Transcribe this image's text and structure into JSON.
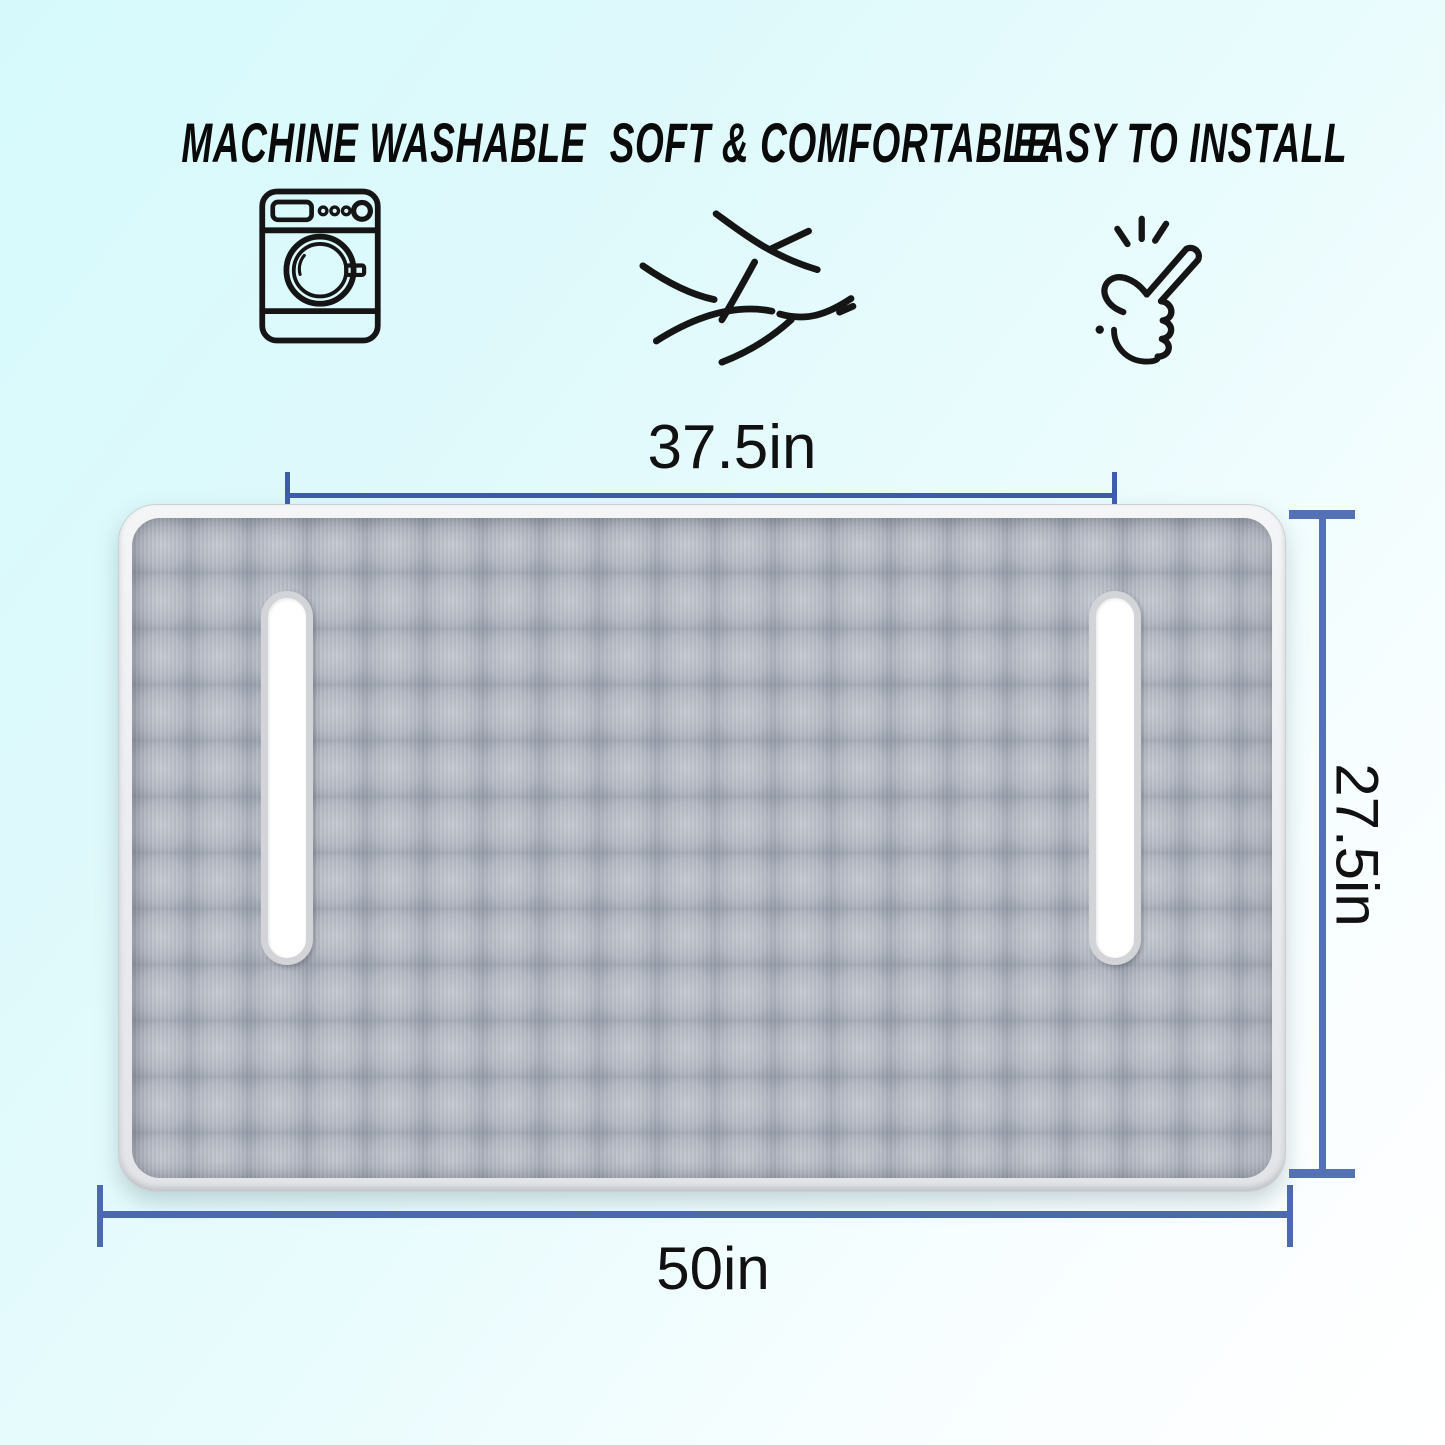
{
  "features": [
    {
      "label": "MACHINE WASHABLE",
      "icon": "washing-machine-icon"
    },
    {
      "label": "SOFT & COMFORTABLE",
      "icon": "fabric-weave-icon"
    },
    {
      "label": "EASY TO INSTALL",
      "icon": "snap-finger-icon"
    }
  ],
  "product": {
    "description": "gray quilted mat with two handle slots",
    "slot_count": 2
  },
  "dimensions": {
    "inner_width": "37.5in",
    "height": "27.5in",
    "outer_width": "50in"
  },
  "colors": {
    "background_top_left": "#d6fafc",
    "background_bottom_right": "#ffffff",
    "feature_text": "#0a0a0a",
    "icon_stroke": "#151515",
    "dim_line_top": "#3d5ca6",
    "dim_line_side": "#5571b6",
    "dim_line_bottom": "#4c68af",
    "dim_text": "#111111",
    "mat_quilt_light": "#c6cad3",
    "mat_quilt_dark": "#858a97",
    "slot_fill": "#ffffff",
    "slot_rim": "#d2d4d8"
  }
}
